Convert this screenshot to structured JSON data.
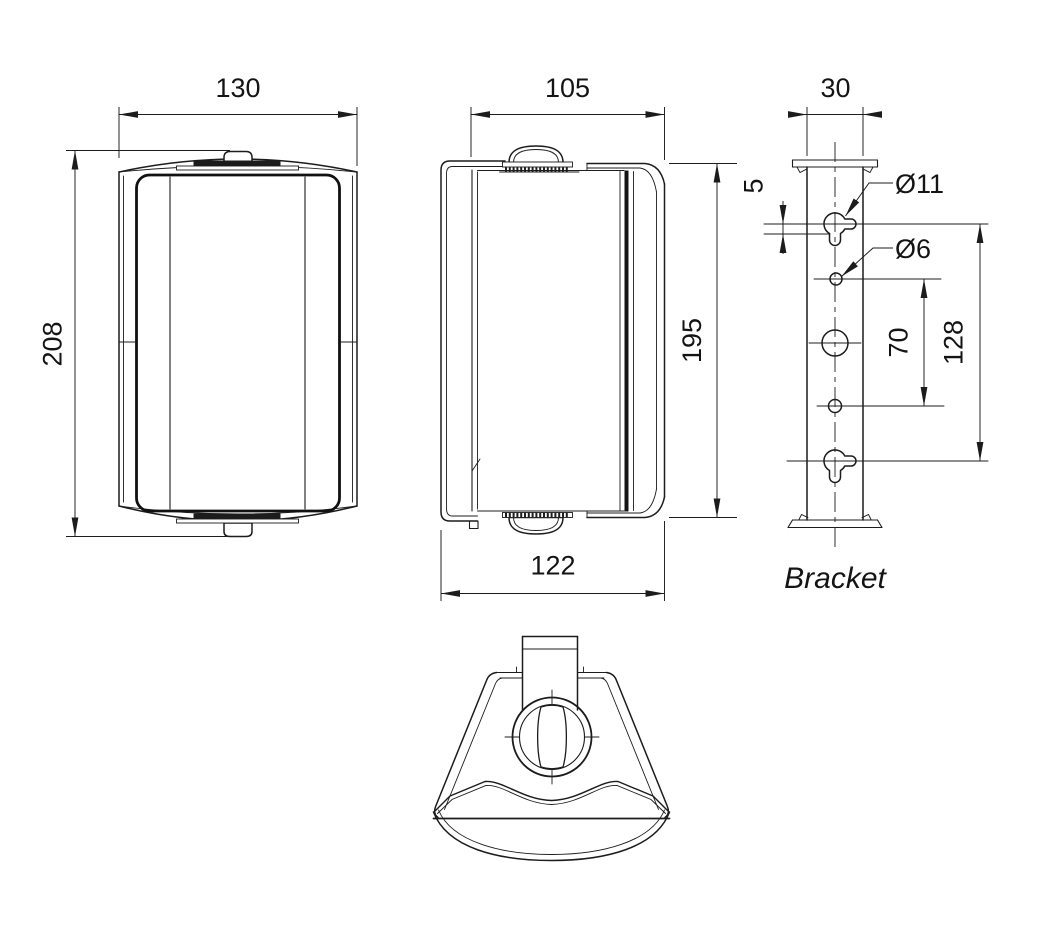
{
  "colors": {
    "line": "#1c1c1c",
    "background": "#ffffff"
  },
  "front_view": {
    "width": "130",
    "height": "208"
  },
  "side_view": {
    "depth": "105",
    "height": "195",
    "total_depth": "122"
  },
  "bracket_view": {
    "title": "Bracket",
    "width": "30",
    "keyhole_offset": "5",
    "keyhole_diameter": "Ø11",
    "hole_diameter": "Ø6",
    "hole_spacing": "70",
    "mounting_span": "128"
  }
}
